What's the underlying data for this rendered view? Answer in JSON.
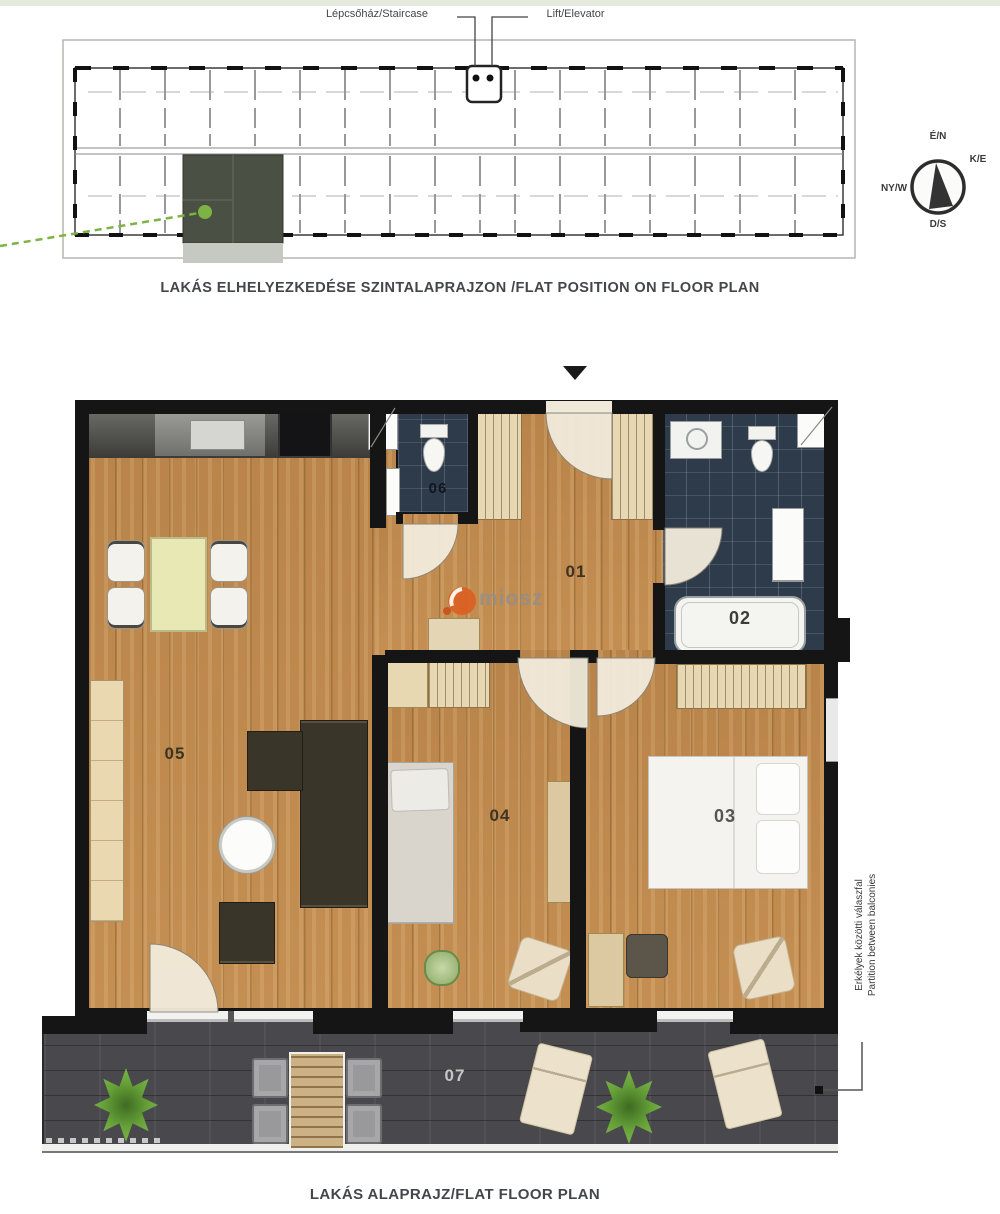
{
  "overview": {
    "staircase_label": "Lépcsőház/Staircase",
    "elevator_label": "Lift/Elevator",
    "caption": "LAKÁS ELHELYEZKEDÉSE SZINTALAPRAJZON /FLAT POSITION ON FLOOR PLAN",
    "compass": {
      "north": "É/N",
      "east": "K/E",
      "south": "D/S",
      "west": "NY/W"
    },
    "highlight_color": "#4b5045",
    "pointer_color": "#7cb342"
  },
  "plan": {
    "caption": "LAKÁS ALAPRAJZ/FLAT FLOOR PLAN",
    "room_labels": {
      "hall": "01",
      "bath": "02",
      "bedroom_large": "03",
      "bedroom_small": "04",
      "living": "05",
      "wc": "06",
      "terrace": "07"
    },
    "partition_note": {
      "line1": "Erkélyek közötti válaszfal",
      "line2": "Partition between balconies"
    }
  },
  "watermark": {
    "text": "miosz",
    "logo_color": "#dd5c1d"
  },
  "colors": {
    "wood": "#c18a4e",
    "bath_tile": "#2d3b4b",
    "terrace_deck": "#49494d",
    "wall": "#151515"
  }
}
